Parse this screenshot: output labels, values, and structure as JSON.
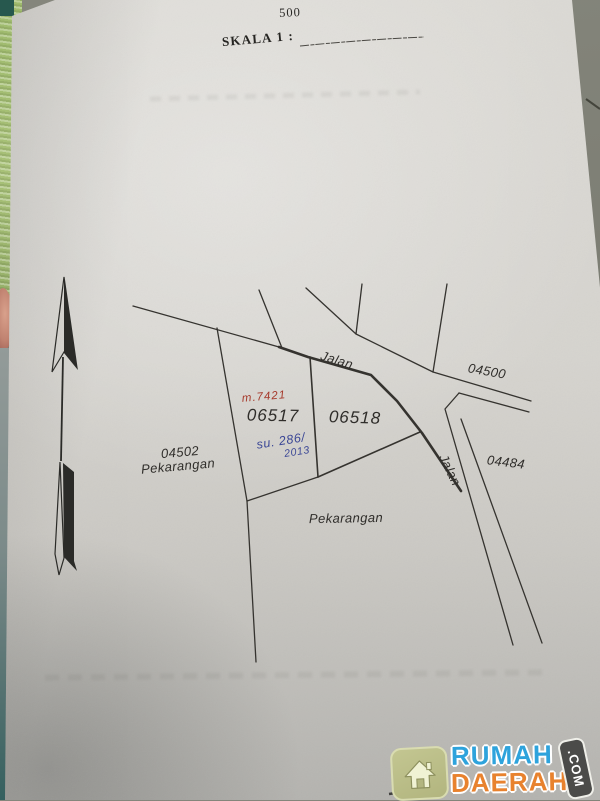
{
  "scale": {
    "value": "500",
    "label": "SKALA 1 :"
  },
  "map": {
    "road_top": "Jalan",
    "road_right": "Jalan",
    "parcel_a": "06517",
    "parcel_b": "06518",
    "parcel_left_id": "04502",
    "parcel_left_use": "Pekarangan",
    "parcel_road_right_id": "04500",
    "parcel_far_right_id": "04484",
    "land_use_bottom": "Pekarangan",
    "annotation_red": "m.7421",
    "annotation_blue_line1": "su. 286/",
    "annotation_blue_line2": "2013"
  },
  "watermark": {
    "line1": "RUMAH",
    "line2": "DAERAH",
    "tld": ".COM"
  },
  "colors": {
    "red_ink": "#a63a2c",
    "blue_ink": "#3b4796",
    "map_line": "#35332f",
    "watermark_blue": "#2ea3dc",
    "watermark_orange": "#e8822e",
    "house_badge": "#b2b57f"
  }
}
